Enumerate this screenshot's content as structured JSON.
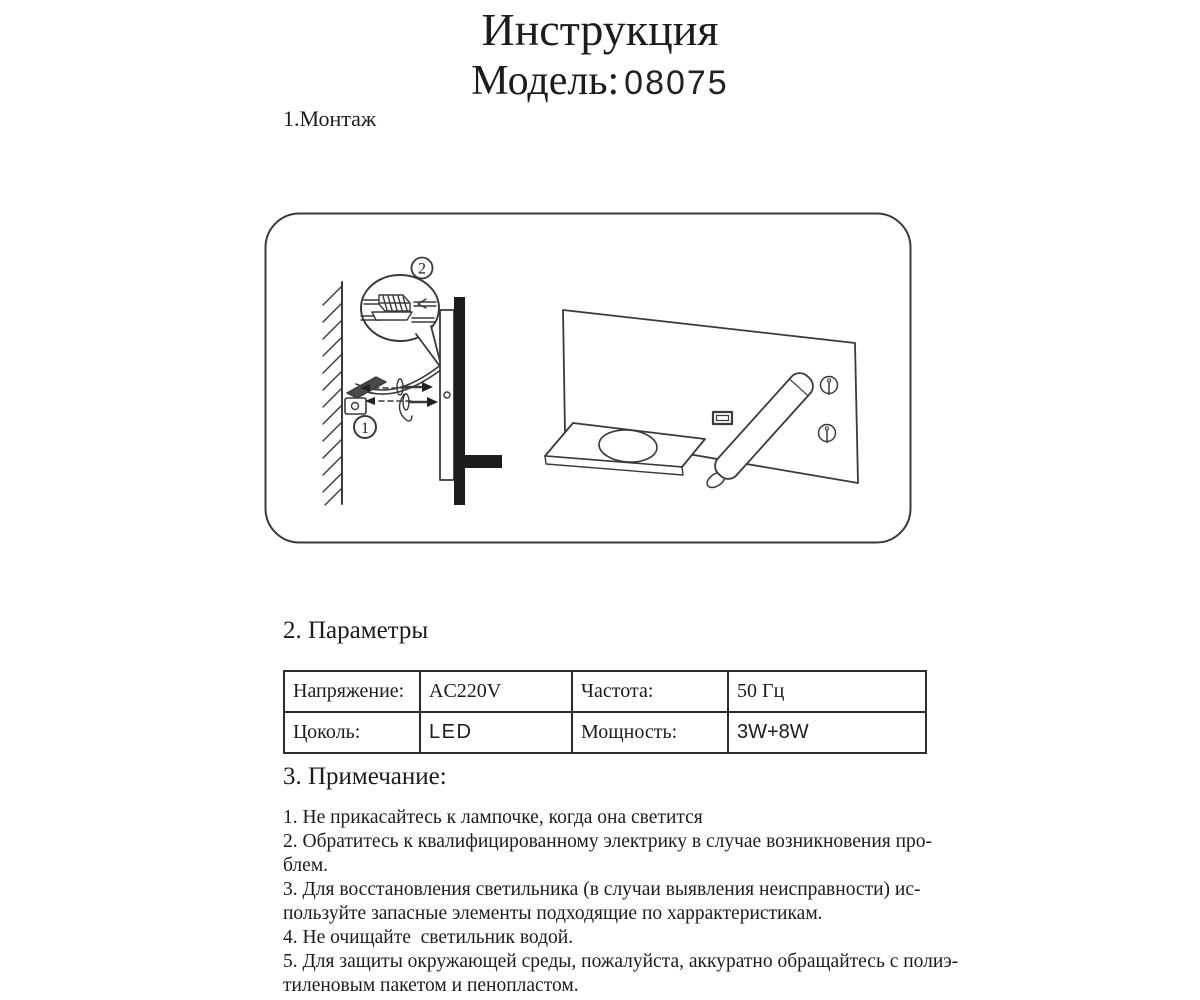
{
  "colors": {
    "ink": "#1c1c1c",
    "line": "#3a3a3a"
  },
  "header": {
    "title": "Инструкция",
    "model_label": "Модель:",
    "model_number": "08075"
  },
  "sections": {
    "montage_heading": "1.Монтаж",
    "parameters_heading": "2. Параметры",
    "notes_heading": "3. Примечание:"
  },
  "diagram": {
    "callouts": [
      {
        "label": "1"
      },
      {
        "label": "2"
      }
    ]
  },
  "parameters_table": {
    "rows": [
      {
        "cells": [
          "Напряжение:",
          "AC220V",
          "Частота:",
          "50 Гц"
        ]
      },
      {
        "cells": [
          "Цоколь:",
          "LED",
          "Мощность:",
          "3W+8W"
        ]
      }
    ]
  },
  "notes": {
    "lines": [
      "1. Не прикасайтесь к лампочке, когда она светится",
      "2. Обратитесь к квалифицированному электрику в случае возникновения про-",
      "блем.",
      "3. Для восстановления светильника (в случаи выявления неисправности) ис-",
      "пользуйте запасные элементы подходящие по харрактеристикам.",
      "4. Не очищайте  светильник водой.",
      "5. Для защиты окружающей среды, пожалуйста, аккуратно обращайтесь с полиэ-",
      "тиленовым пакетом и пенопластом."
    ]
  }
}
